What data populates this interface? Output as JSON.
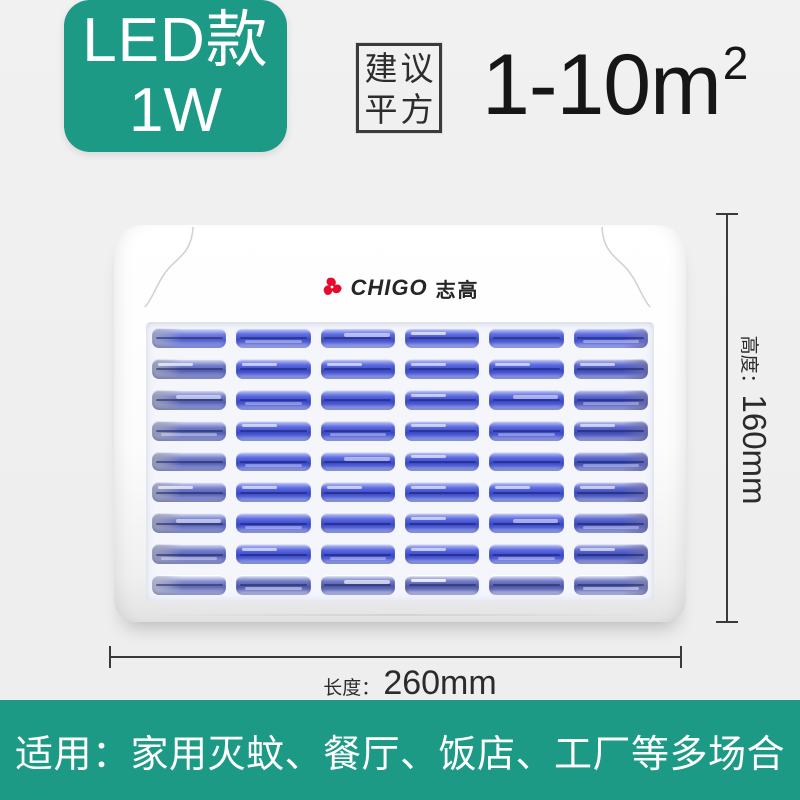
{
  "badge": {
    "line1": "LED款",
    "line2": "1W"
  },
  "suggest": {
    "box_line1": "建议",
    "box_line2": "平方",
    "area_value": "1-10m",
    "area_sup": "2"
  },
  "product": {
    "brand_en": "CHIGO",
    "brand_cn": "志高",
    "logo_icon": "chigo-pinwheel-icon"
  },
  "grille": {
    "rows": 9,
    "cols": 6
  },
  "dimensions": {
    "height_label": "高度：",
    "height_value": "160mm",
    "length_label": "长度：",
    "length_value": "260mm"
  },
  "banner": {
    "text": "适用：家用灭蚊、餐厅、饭店、工厂等多场合"
  },
  "colors": {
    "teal": "#1d9a86",
    "logo_red": "#e60a2d",
    "bar_blue": "#4453d2",
    "bar_blue_light": "#9aa4ea",
    "grille_bg": "#f5f6fc",
    "dim_line": "#3a3a3a",
    "ink": "#161616"
  }
}
